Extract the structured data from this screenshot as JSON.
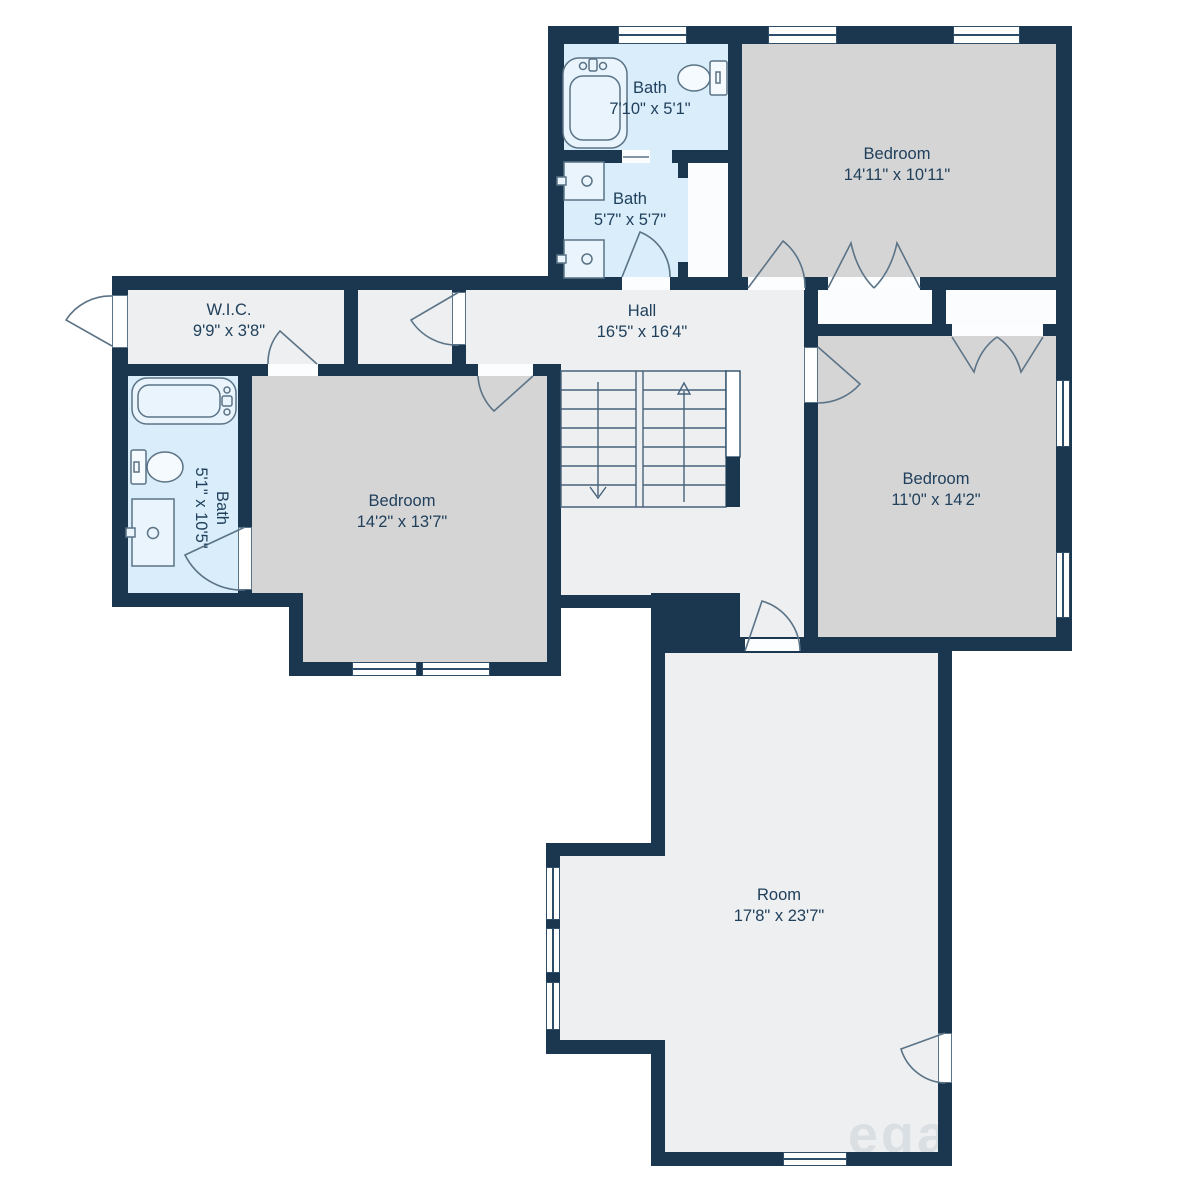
{
  "plan": {
    "watermark": "ega",
    "rooms": {
      "bath_top": {
        "name": "Bath",
        "dims": "7'10\" x 5'1\""
      },
      "bath_mid": {
        "name": "Bath",
        "dims": "5'7\" x 5'7\""
      },
      "bedroom_top": {
        "name": "Bedroom",
        "dims": "14'11\" x 10'11\""
      },
      "wic": {
        "name": "W.I.C.",
        "dims": "9'9\" x 3'8\""
      },
      "hall": {
        "name": "Hall",
        "dims": "16'5\" x 16'4\""
      },
      "bath_left": {
        "name": "Bath",
        "dims": "5'1\" x 10'5\""
      },
      "bedroom_left": {
        "name": "Bedroom",
        "dims": "14'2\" x 13'7\""
      },
      "bedroom_right": {
        "name": "Bedroom",
        "dims": "11'0\" x 14'2\""
      },
      "room": {
        "name": "Room",
        "dims": "17'8\" x 23'7\""
      }
    },
    "colors": {
      "wall": "#1a374f",
      "hall_floor": "#edeff1",
      "bedroom_floor": "#d5d5d6",
      "bath_floor": "#d9edfa",
      "closet_floor": "#fbfcfd",
      "label_text": "#20405c"
    }
  }
}
